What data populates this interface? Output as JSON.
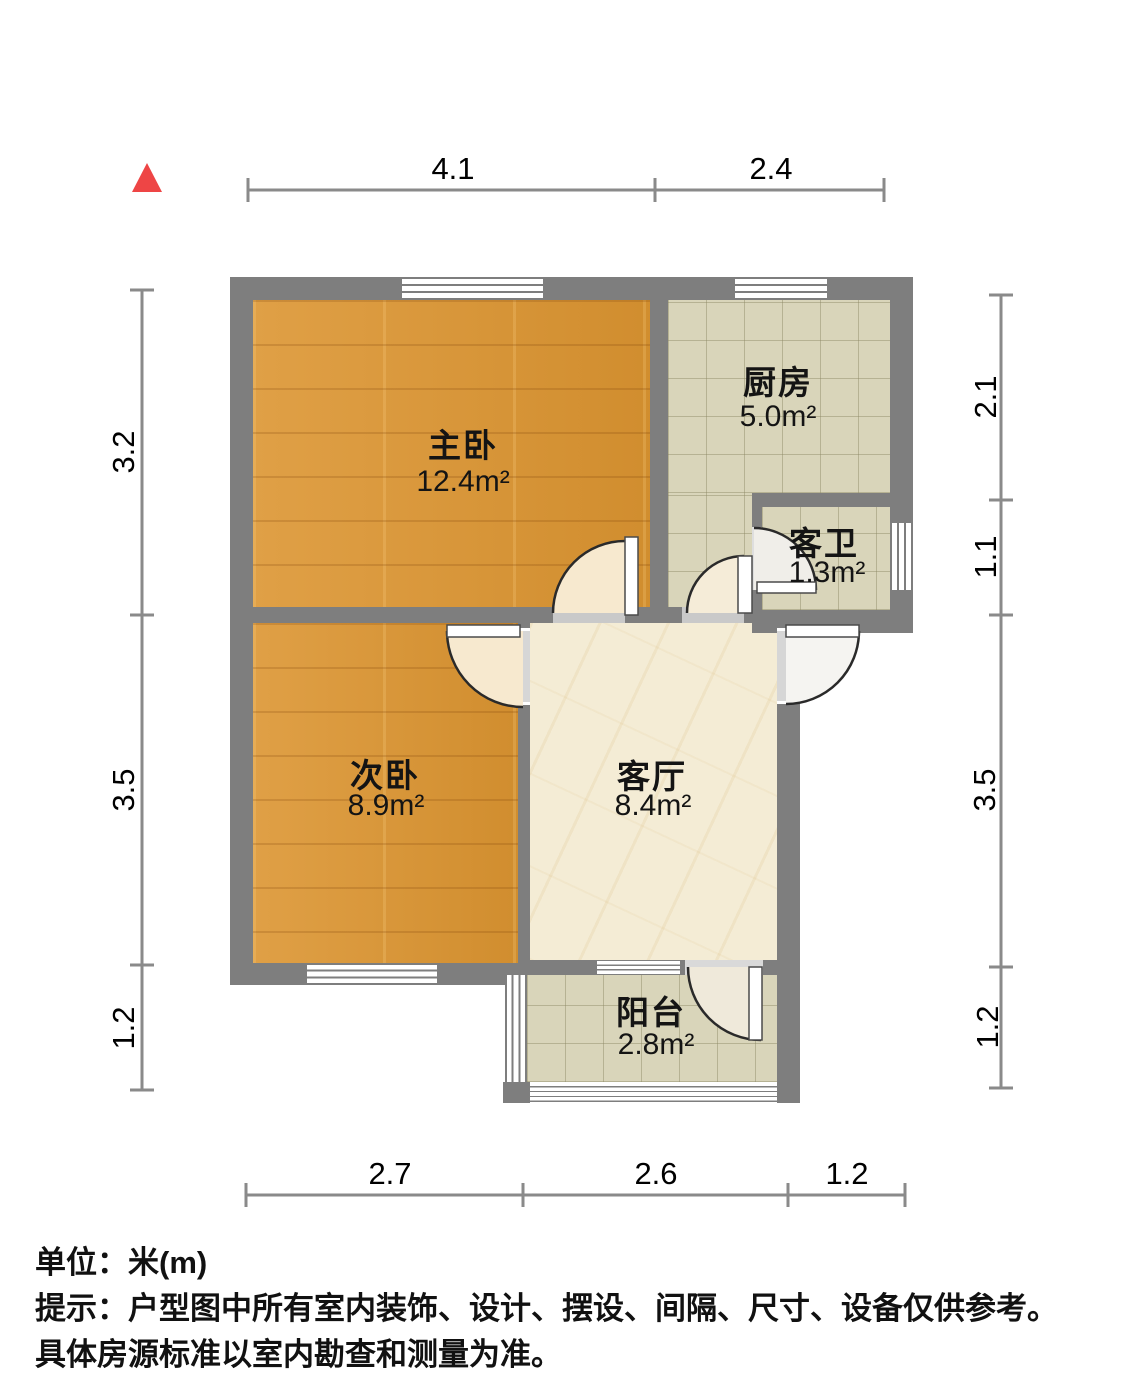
{
  "compass": {
    "icon": "north-triangle-icon"
  },
  "dims": {
    "top": [
      "4.1",
      "2.4"
    ],
    "bottom": [
      "2.7",
      "2.6",
      "1.2"
    ],
    "left": [
      "3.2",
      "3.5",
      "1.2"
    ],
    "right": [
      "2.1",
      "1.1",
      "3.5",
      "1.2"
    ]
  },
  "rooms": {
    "master": {
      "name": "主卧",
      "area": "12.4m²"
    },
    "kitchen": {
      "name": "厨房",
      "area": "5.0m²"
    },
    "bath": {
      "name": "客卫",
      "area": "1.3m²"
    },
    "second": {
      "name": "次卧",
      "area": "8.9m²"
    },
    "living": {
      "name": "客厅",
      "area": "8.4m²"
    },
    "balcony": {
      "name": "阳台",
      "area": "2.8m²"
    }
  },
  "footer": {
    "unit": "单位：米(m)",
    "note1": "提示：户型图中所有室内装饰、设计、摆设、间隔、尺寸、设备仅供参考。",
    "note2": "具体房源标准以室内勘查和测量为准。"
  },
  "colors": {
    "wall": "#7e7e7e",
    "wood": "#dc9531",
    "tile": "#d9d5ba",
    "marble": "#f4ecd5",
    "north_arrow": "#ee4545"
  }
}
